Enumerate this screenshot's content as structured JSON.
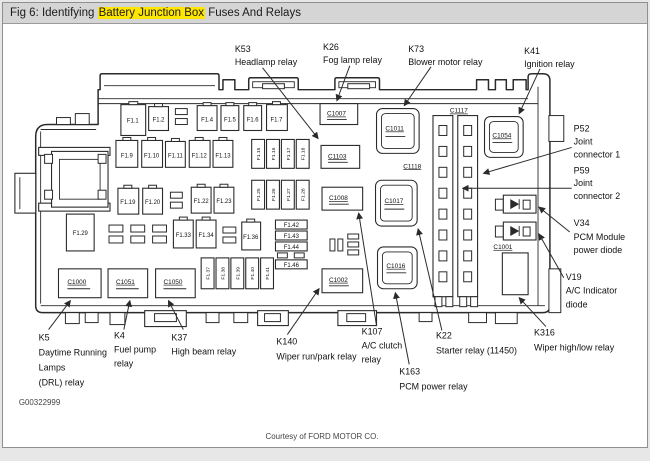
{
  "window": {
    "title_prefix": "Fig 6: Identifying ",
    "title_highlight": "Battery Junction Box",
    "title_suffix": " Fuses And Relays"
  },
  "colors": {
    "highlight": "#ffe600",
    "titlebar_bg": "#d5d5d5",
    "line": "#2a2a2a"
  },
  "diagram": {
    "figure_code": "G00322999",
    "credit": "Courtesy of FORD MOTOR CO.",
    "fuses": {
      "f1_1": "F1.1",
      "f1_2": "F1.2",
      "f1_4": "F1.4",
      "f1_5": "F1.5",
      "f1_6": "F1.6",
      "f1_7": "F1.7",
      "f1_9": "F1.9",
      "f1_10": "F1.10",
      "f1_11": "F1.11",
      "f1_12": "F1.12",
      "f1_13": "F1.13",
      "f1_15": "F1.15",
      "f1_16": "F1.16",
      "f1_17": "F1.17",
      "f1_18": "F1.18",
      "f1_19": "F1.19",
      "f1_20": "F1.20",
      "f1_22": "F1.22",
      "f1_23": "F1.23",
      "f1_25": "F1.25",
      "f1_26": "F1.26",
      "f1_27": "F1.27",
      "f1_28": "F1.28",
      "f1_29": "F1.29",
      "f1_33": "F1.33",
      "f1_34": "F1.34",
      "f1_36": "F1.36",
      "f1_37": "F1.37",
      "f1_38": "F1.38",
      "f1_39": "F1.39",
      "f1_40": "F1.40",
      "f1_41": "F1.41",
      "f1_42": "F1.42",
      "f1_43": "F1.43",
      "f1_44": "F1.44",
      "f1_46": "F1.46"
    },
    "connectors": {
      "c1000": "C1000",
      "c1051": "C1051",
      "c1050": "C1050",
      "c1002": "C1002",
      "c1007": "C1007",
      "c1103": "C1103",
      "c1008": "C1008",
      "c1011": "C1011",
      "c1017": "C1017",
      "c1016": "C1016",
      "c1054": "C1054",
      "c1001": "C1001",
      "c1117": "C1117",
      "c1118": "C1118"
    },
    "callouts": {
      "k53": {
        "code": "K53",
        "name": "Headlamp relay"
      },
      "k26": {
        "code": "K26",
        "name": "Fog lamp relay"
      },
      "k73": {
        "code": "K73",
        "name": "Blower motor relay"
      },
      "k41": {
        "code": "K41",
        "name": "Ignition relay"
      },
      "p52": {
        "code": "P52",
        "line1": "Joint",
        "line2": "connector 1"
      },
      "p59": {
        "code": "P59",
        "line1": "Joint",
        "line2": "connector 2"
      },
      "v34": {
        "code": "V34",
        "line1": "PCM Module",
        "line2": "power diode"
      },
      "v19": {
        "code": "V19",
        "line1": "A/C Indicator",
        "line2": "diode"
      },
      "k316": {
        "code": "K316",
        "name": "Wiper high/low relay"
      },
      "k5": {
        "code": "K5",
        "line1": "Daytime Running",
        "line2": "Lamps",
        "line3": "(DRL) relay"
      },
      "k4": {
        "code": "K4",
        "line1": "Fuel pump",
        "line2": "relay"
      },
      "k37": {
        "code": "K37",
        "name": "High beam relay"
      },
      "k140": {
        "code": "K140",
        "name": "Wiper run/park relay"
      },
      "k107": {
        "code": "K107",
        "line1": "A/C clutch",
        "line2": "relay"
      },
      "k163": {
        "code": "K163",
        "name": "PCM power relay"
      },
      "k22": {
        "code": "K22",
        "name": "Starter relay (11450)"
      }
    }
  }
}
